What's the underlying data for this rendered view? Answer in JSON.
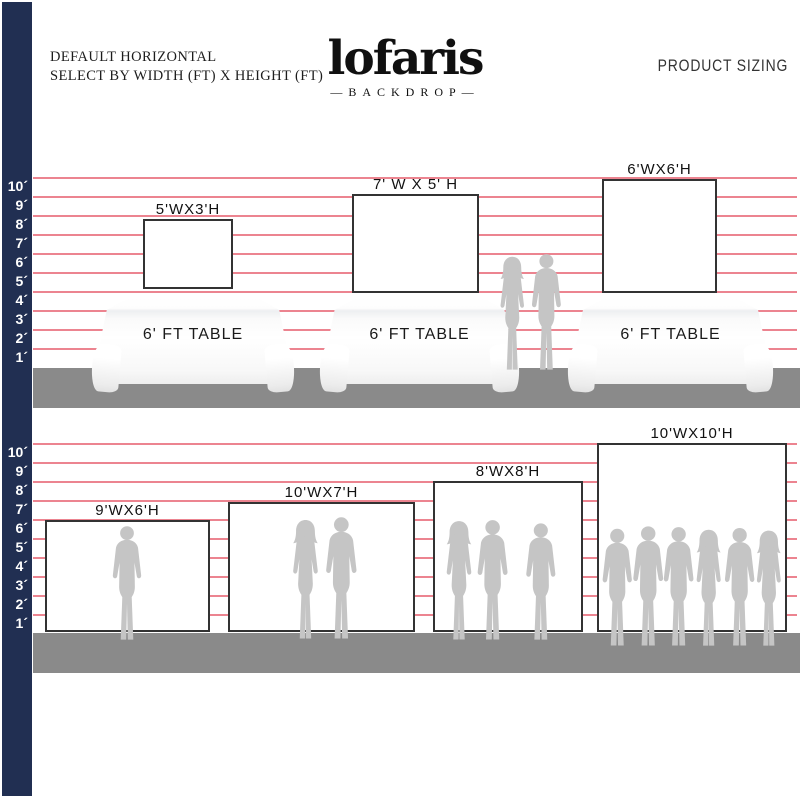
{
  "header": {
    "tagline_line1": "DEFAULT HORIZONTAL",
    "tagline_line2": "SELECT BY WIDTH (FT) X HEIGHT (FT)",
    "logo_name": "lofaris",
    "logo_sub": "—BACKDROP—",
    "product_sizing": "PRODUCT SIZING"
  },
  "ruler_labels": [
    "10´",
    "9´",
    "8´",
    "7´",
    "6´",
    "5´",
    "4´",
    "3´",
    "2´",
    "1´"
  ],
  "top_section": {
    "backdrops": [
      {
        "label": "5'WX3'H",
        "width_ft": 5,
        "height_ft": 3
      },
      {
        "label": "7' W X 5' H",
        "width_ft": 7,
        "height_ft": 5
      },
      {
        "label": "6'WX6'H",
        "width_ft": 6,
        "height_ft": 6
      }
    ],
    "table_label": "6' FT TABLE"
  },
  "bottom_section": {
    "backdrops": [
      {
        "label": "9'WX6'H",
        "width_ft": 9,
        "height_ft": 6
      },
      {
        "label": "10'WX7'H",
        "width_ft": 10,
        "height_ft": 7
      },
      {
        "label": "8'WX8'H",
        "width_ft": 8,
        "height_ft": 8
      },
      {
        "label": "10'WX10'H",
        "width_ft": 10,
        "height_ft": 10
      }
    ]
  },
  "colors": {
    "navy": "#212f52",
    "gridline": "#ec8490",
    "floor": "#8a8a8a",
    "silhouette": "#c5c5c5",
    "backdrop_border": "#333333"
  },
  "icons": {
    "silhouettes": [
      "man-silhouette",
      "woman-silhouette"
    ]
  }
}
